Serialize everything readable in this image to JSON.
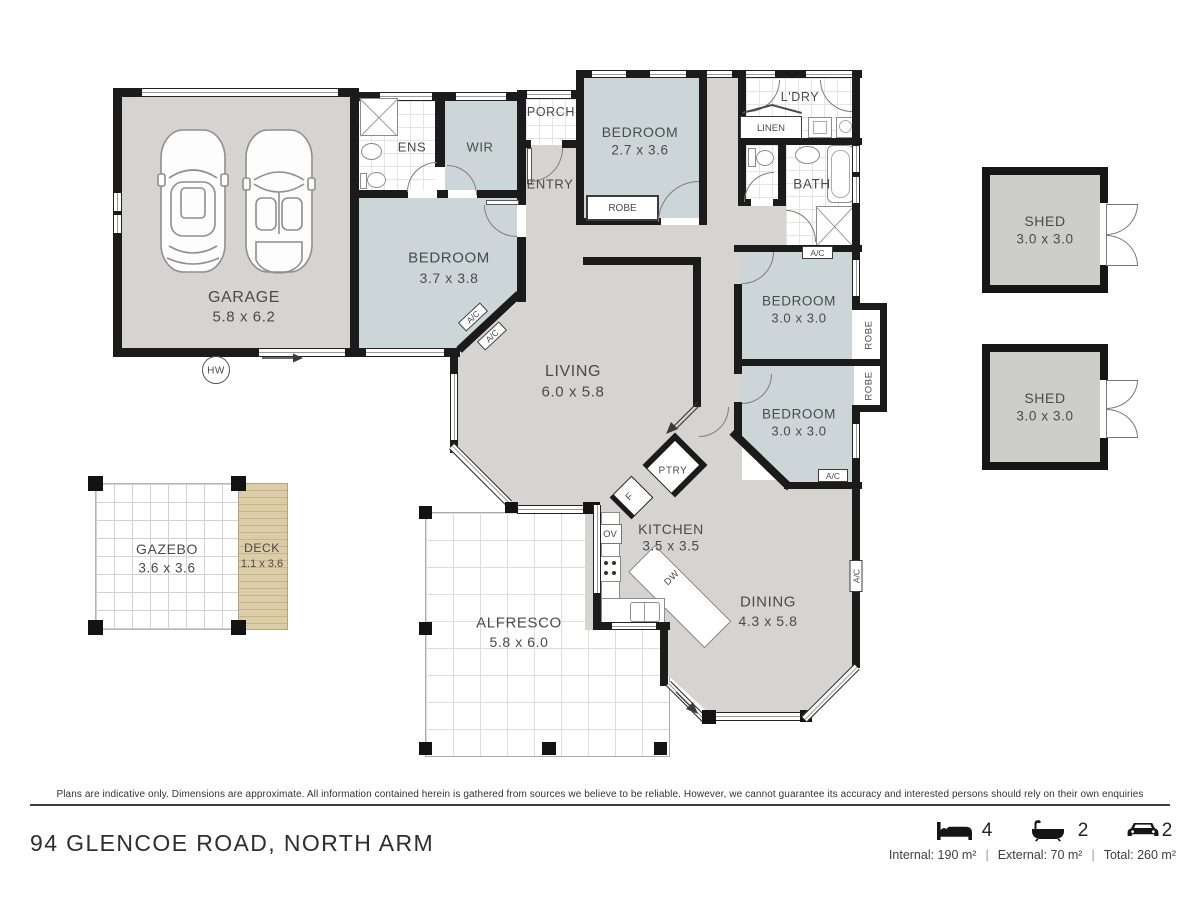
{
  "plan": {
    "rooms": {
      "garage": {
        "name": "GARAGE",
        "dims": "5.8 x 6.2"
      },
      "ens": {
        "name": "ENS"
      },
      "wir": {
        "name": "WIR"
      },
      "bed1": {
        "name": "BEDROOM",
        "dims": "3.7 x 3.8"
      },
      "porch": {
        "name": "PORCH"
      },
      "entry": {
        "name": "ENTRY"
      },
      "bed2": {
        "name": "BEDROOM",
        "dims": "2.7 x 3.6"
      },
      "ldry": {
        "name": "L'DRY"
      },
      "bath": {
        "name": "BATH"
      },
      "bed3": {
        "name": "BEDROOM",
        "dims": "3.0 x 3.0"
      },
      "bed4": {
        "name": "BEDROOM",
        "dims": "3.0 x 3.0"
      },
      "living": {
        "name": "LIVING",
        "dims": "6.0 x 5.8"
      },
      "kitchen": {
        "name": "KITCHEN",
        "dims": "3.5 x 3.5"
      },
      "dining": {
        "name": "DINING",
        "dims": "4.3 x 5.8"
      },
      "alfresco": {
        "name": "ALFRESCO",
        "dims": "5.8 x 6.0"
      },
      "gazebo": {
        "name": "GAZEBO",
        "dims": "3.6 x 3.6"
      },
      "deck": {
        "name": "DECK",
        "dims": "1.1 x 3.6"
      },
      "shed": {
        "name": "SHED",
        "dims": "3.0 x 3.0"
      }
    },
    "fixtures": {
      "robe": "ROBE",
      "linen": "LINEN",
      "ac": "A/C",
      "hw": "HW",
      "ov": "OV",
      "dw": "DW",
      "fridge": "F",
      "pantry": "PTRY"
    }
  },
  "footer": {
    "disclaimer": "Plans are indicative only. Dimensions are approximate. All information contained herein is gathered from sources we believe to be reliable. However, we cannot guarantee its accuracy and interested persons should rely on their own enquiries",
    "address": "94 GLENCOE ROAD, NORTH ARM",
    "beds": "4",
    "baths": "2",
    "cars": "2",
    "areas": {
      "internal": "Internal: 190 m²",
      "external": "External: 70 m²",
      "total": "Total: 260 m²"
    },
    "separator": "|"
  }
}
